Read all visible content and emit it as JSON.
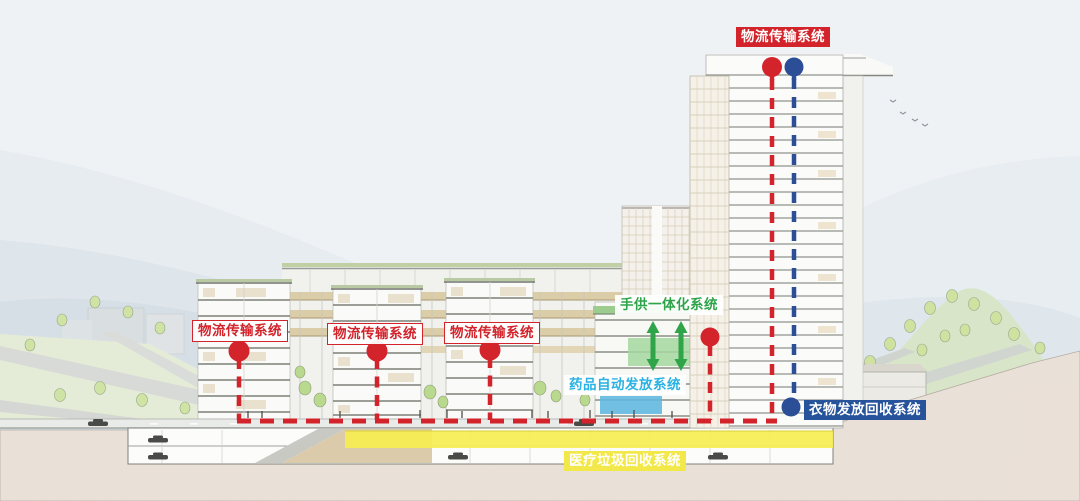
{
  "diagram": {
    "labels": {
      "tower_logistics": "物流传输系统",
      "podium_logistics_1": "物流传输系统",
      "podium_logistics_2": "物流传输系统",
      "podium_logistics_3": "物流传输系统",
      "hand_supply": "手供一体化系统",
      "drug_dispensing": "药品自动发放系统",
      "clothing_recycling": "衣物发放回收系统",
      "medical_waste": "医疗垃圾回收系统"
    },
    "legend_colors": {
      "logistics_red": "#d3232b",
      "clothing_blue": "#27539b",
      "hand_supply_green": "#2ea44a",
      "drug_cyan": "#29b2e2",
      "medical_waste_yellow": "#f2e849"
    }
  }
}
